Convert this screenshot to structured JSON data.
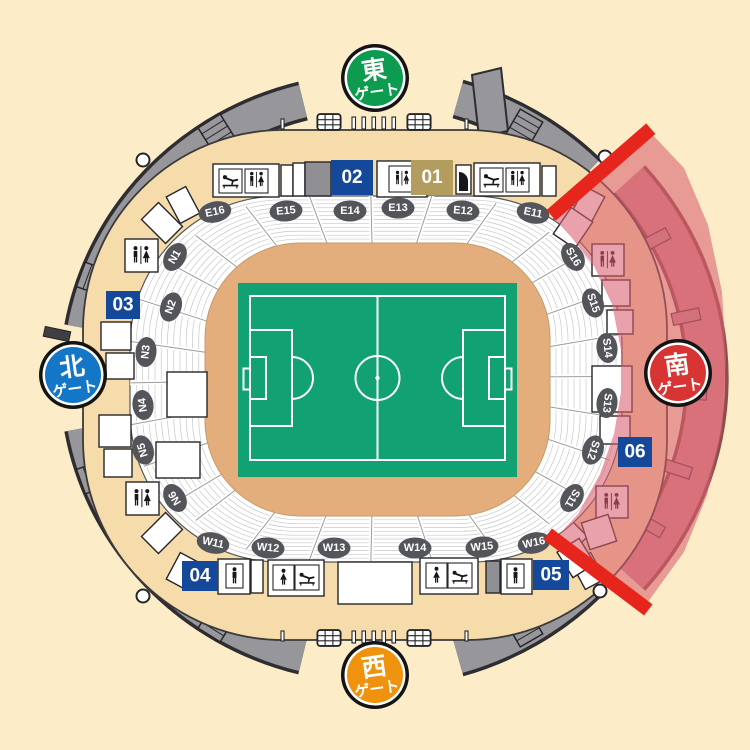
{
  "gates": {
    "east": {
      "char": "東",
      "word": "ゲート",
      "color": "#0d9b50"
    },
    "west": {
      "char": "西",
      "word": "ゲート",
      "color": "#ef930e"
    },
    "north": {
      "char": "北",
      "word": "ゲート",
      "color": "#1476c6"
    },
    "south": {
      "char": "南",
      "word": "ゲート",
      "color": "#d93434"
    }
  },
  "blocks": {
    "b01": {
      "label": "01",
      "color": "#b29c5e"
    },
    "b02": {
      "label": "02",
      "color": "#14489b"
    },
    "b03": {
      "label": "03",
      "color": "#14489b"
    },
    "b04": {
      "label": "04",
      "color": "#14489b"
    },
    "b05": {
      "label": "05",
      "color": "#14489b"
    },
    "b06": {
      "label": "06",
      "color": "#14489b"
    }
  },
  "sections": {
    "east": [
      "E16",
      "E15",
      "E14",
      "E13",
      "E12",
      "E11"
    ],
    "north": [
      "N1",
      "N2",
      "N3",
      "N4",
      "N5",
      "N6"
    ],
    "west": [
      "W11",
      "W12",
      "W13",
      "W14",
      "W15",
      "W16"
    ],
    "south": [
      "S16",
      "S15",
      "S14",
      "S13",
      "S12",
      "S11"
    ]
  },
  "highlight": {
    "zone": "south-gate-area",
    "bar_color": "#e6261c",
    "fill_color": "#d95f6e"
  },
  "icons": {
    "restroom": "wc",
    "mens_restroom": "man",
    "womens_restroom": "woman",
    "baby_changing": "baby-change",
    "door": "door",
    "stairs": "stairs",
    "turnstile": "turnstile"
  },
  "colors": {
    "background": "#fcedc8",
    "concourse": "#f7dcab",
    "seating": "#ffffff",
    "infield": "#e3ae7b",
    "pitch": "#12a173",
    "ramp_gray": "#97979b",
    "label_gray": "#54555a"
  }
}
